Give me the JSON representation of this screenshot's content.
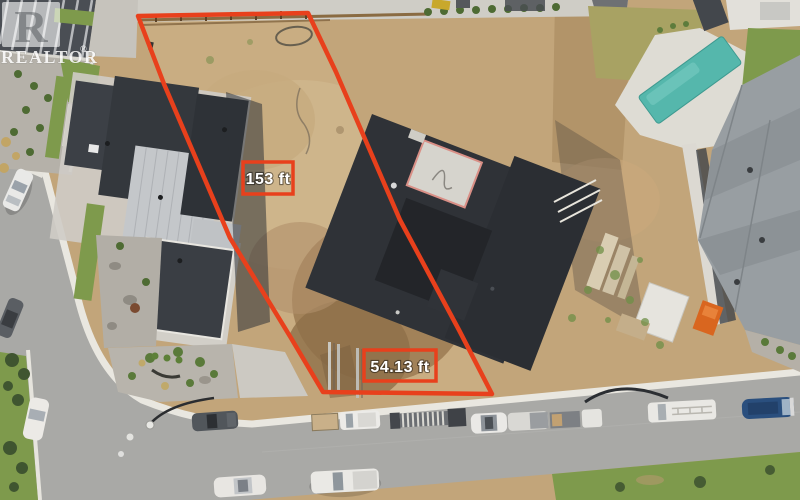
{
  "watermark": {
    "brand": "REALTOR",
    "registered": "®",
    "logo_letter": "R"
  },
  "boundary": {
    "color": "#e8401c",
    "labels": {
      "side": "153 ft",
      "front": "54.13 ft"
    }
  },
  "palette": {
    "dirt": "#c2a57a",
    "lot_dirt": "#c9ad82",
    "asphalt": "#a9a9a6",
    "sidewalk": "#e9e7e0",
    "pool_water": "#55b7ac",
    "roof_charcoal": "#2f3237",
    "roof_silver": "#c4c7ca",
    "roof_gray_shingle": "#989ea2",
    "grass_green": "#7e9a4c",
    "label_text": "#ffffff"
  }
}
